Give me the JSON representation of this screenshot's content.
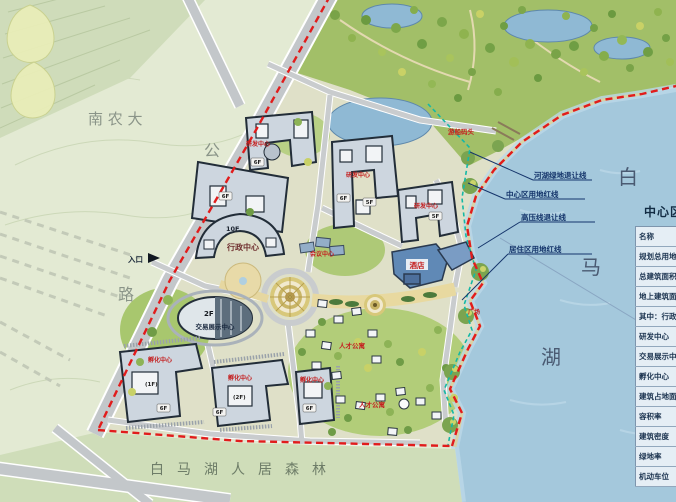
{
  "map": {
    "area_labels": {
      "university": "南 农 大",
      "road_char_top": "公",
      "road_char_bottom": "路",
      "lake_char_1": "白",
      "lake_char_2": "马",
      "lake_char_3": "湖",
      "forest_band": "白马湖人居森林",
      "entrance": "入口"
    },
    "setback_lines": [
      {
        "label": "河湖绿地退让线"
      },
      {
        "label": "中心区用地红线"
      },
      {
        "label": "高压线退让线"
      },
      {
        "label": "居住区用地红线"
      }
    ],
    "buildings": {
      "admin_floor": "10F",
      "admin_name": "行政中心",
      "expo_floor": "2F",
      "expo_name": "交易展示中心",
      "hotel_name": "酒店",
      "conference_name": "会议中心",
      "dock_name": "游船码头",
      "plaza_name": "广场",
      "rnd_labels": [
        "研发中心",
        "研发中心",
        "研发中心"
      ],
      "incubator_labels": [
        "孵化中心",
        "孵化中心",
        "孵化中心"
      ],
      "apartment_labels": [
        "人才公寓",
        "人才公寓"
      ],
      "floor_tags": [
        "6F",
        "6F",
        "6F",
        "5F",
        "5F",
        "6F",
        "6F",
        "6F",
        "(1F)",
        "(2F)"
      ]
    }
  },
  "legend": {
    "title": "中心区经济技术指标",
    "rows": [
      "名称",
      "规划总用地",
      "总建筑面积",
      "地上建筑面积",
      "其中：行政中心",
      "研发中心",
      "交易展示中心",
      "孵化中心",
      "建筑占地面积",
      "容积率",
      "建筑密度",
      "绿地率",
      "机动车位"
    ]
  },
  "colors": {
    "boundary_red": "#e11c1c",
    "setback_teal": "#14b8a6",
    "lake_blue": "#a4c8dc",
    "park_green": "#a2bf68",
    "label_red": "#c42020"
  }
}
